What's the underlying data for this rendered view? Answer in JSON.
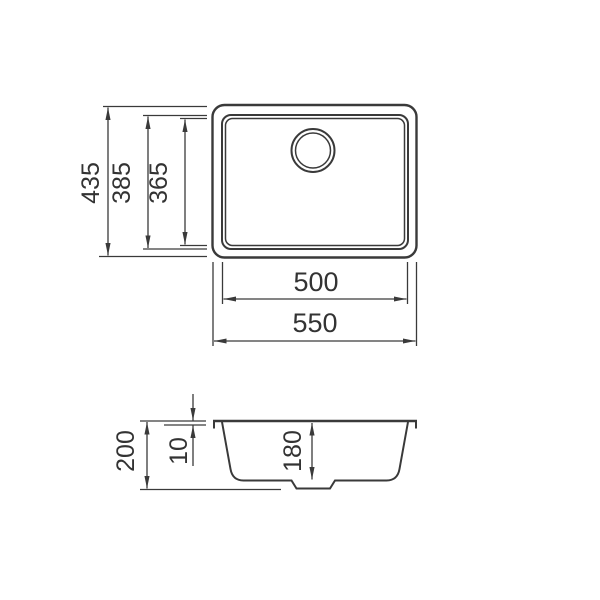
{
  "drawing": {
    "type": "technical-dimension-drawing",
    "subject": "undermount-sink",
    "views": {
      "top": "plan-view",
      "side": "section-view"
    }
  },
  "top_view": {
    "outer_width": "550",
    "inner_width": "500",
    "outer_height": "435",
    "rim_height": "385",
    "bowl_height": "365"
  },
  "side_view": {
    "total_height": "200",
    "rim_thickness": "10",
    "bowl_depth": "180"
  },
  "colors": {
    "line": "#3a3a3a",
    "text": "#333333",
    "background": "#ffffff"
  }
}
